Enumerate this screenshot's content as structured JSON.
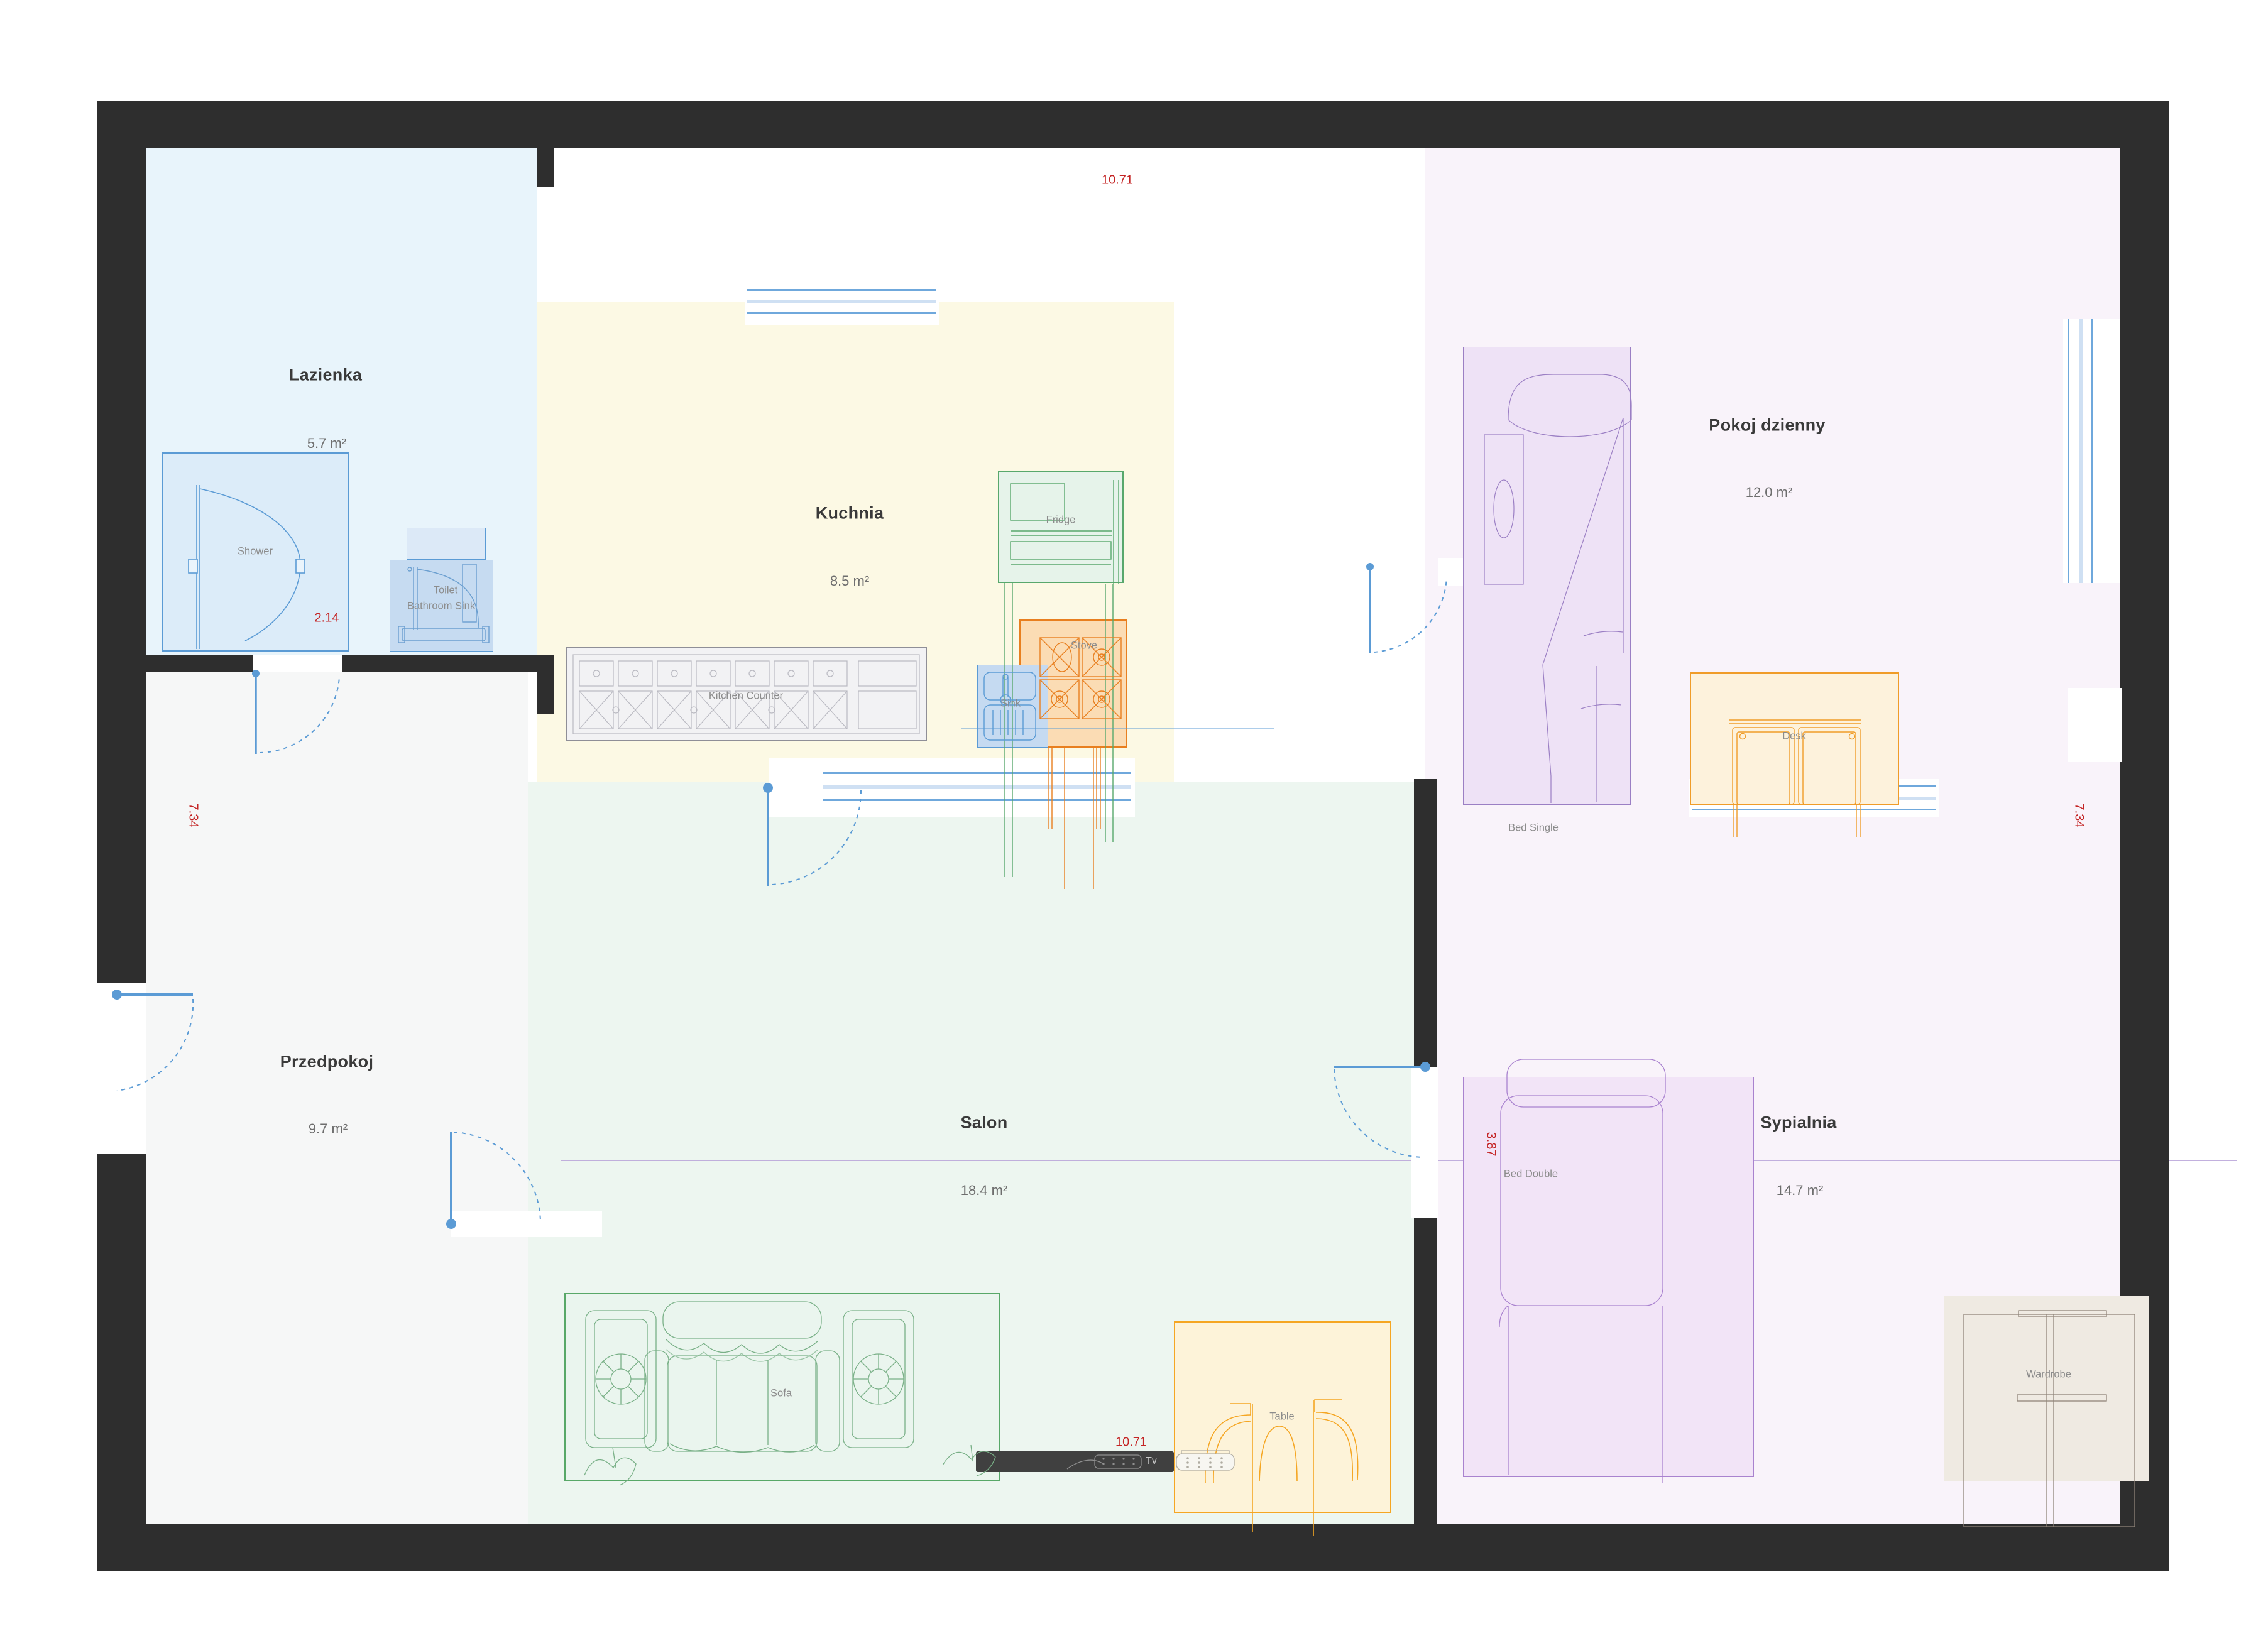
{
  "rooms": [
    {
      "id": "lazienka",
      "name": "Lazienka",
      "area": "5.7 m²"
    },
    {
      "id": "kuchnia",
      "name": "Kuchnia",
      "area": "8.5 m²"
    },
    {
      "id": "pokoj-dzienny",
      "name": "Pokoj dzienny",
      "area": "12.0 m²"
    },
    {
      "id": "przedpokoj",
      "name": "Przedpokoj",
      "area": "9.7 m²"
    },
    {
      "id": "salon",
      "name": "Salon",
      "area": "18.4 m²"
    },
    {
      "id": "sypialnia",
      "name": "Sypialnia",
      "area": "14.7 m²"
    }
  ],
  "furniture": {
    "shower": {
      "label": "Shower"
    },
    "toilet": {
      "label": "Toilet"
    },
    "bathroom_sink": {
      "label": "Bathroom Sink"
    },
    "kitchen_counter": {
      "label": "Kitchen Counter"
    },
    "fridge": {
      "label": "Fridge"
    },
    "stove": {
      "label": "Stove"
    },
    "sink": {
      "label": "Sink"
    },
    "bed_single": {
      "label": "Bed Single"
    },
    "desk": {
      "label": "Desk"
    },
    "bed_double": {
      "label": "Bed Double"
    },
    "wardrobe": {
      "label": "Wardrobe"
    },
    "sofa": {
      "label": "Sofa"
    },
    "table": {
      "label": "Table"
    },
    "tv": {
      "label": "Tv"
    }
  },
  "dims": {
    "top": "10.71",
    "bottom": "10.71",
    "shower": "2.14",
    "left": "7.34",
    "right": "7.34",
    "sypialnia": "3.87"
  },
  "colors": {
    "wall": "#2e2e2e",
    "door": "#5b9bd5",
    "window_solid": "#6fa8dc",
    "window_light": "#cfe0f3",
    "dimension": "#c42525",
    "lazienka_floor": "#e8f4fb",
    "kuchnia_floor": "#fcf9e4",
    "przedpokoj_floor": "#f6f7f7",
    "salon_floor": "#edf6f0",
    "pokoj_floor": "#f9f3fa"
  }
}
